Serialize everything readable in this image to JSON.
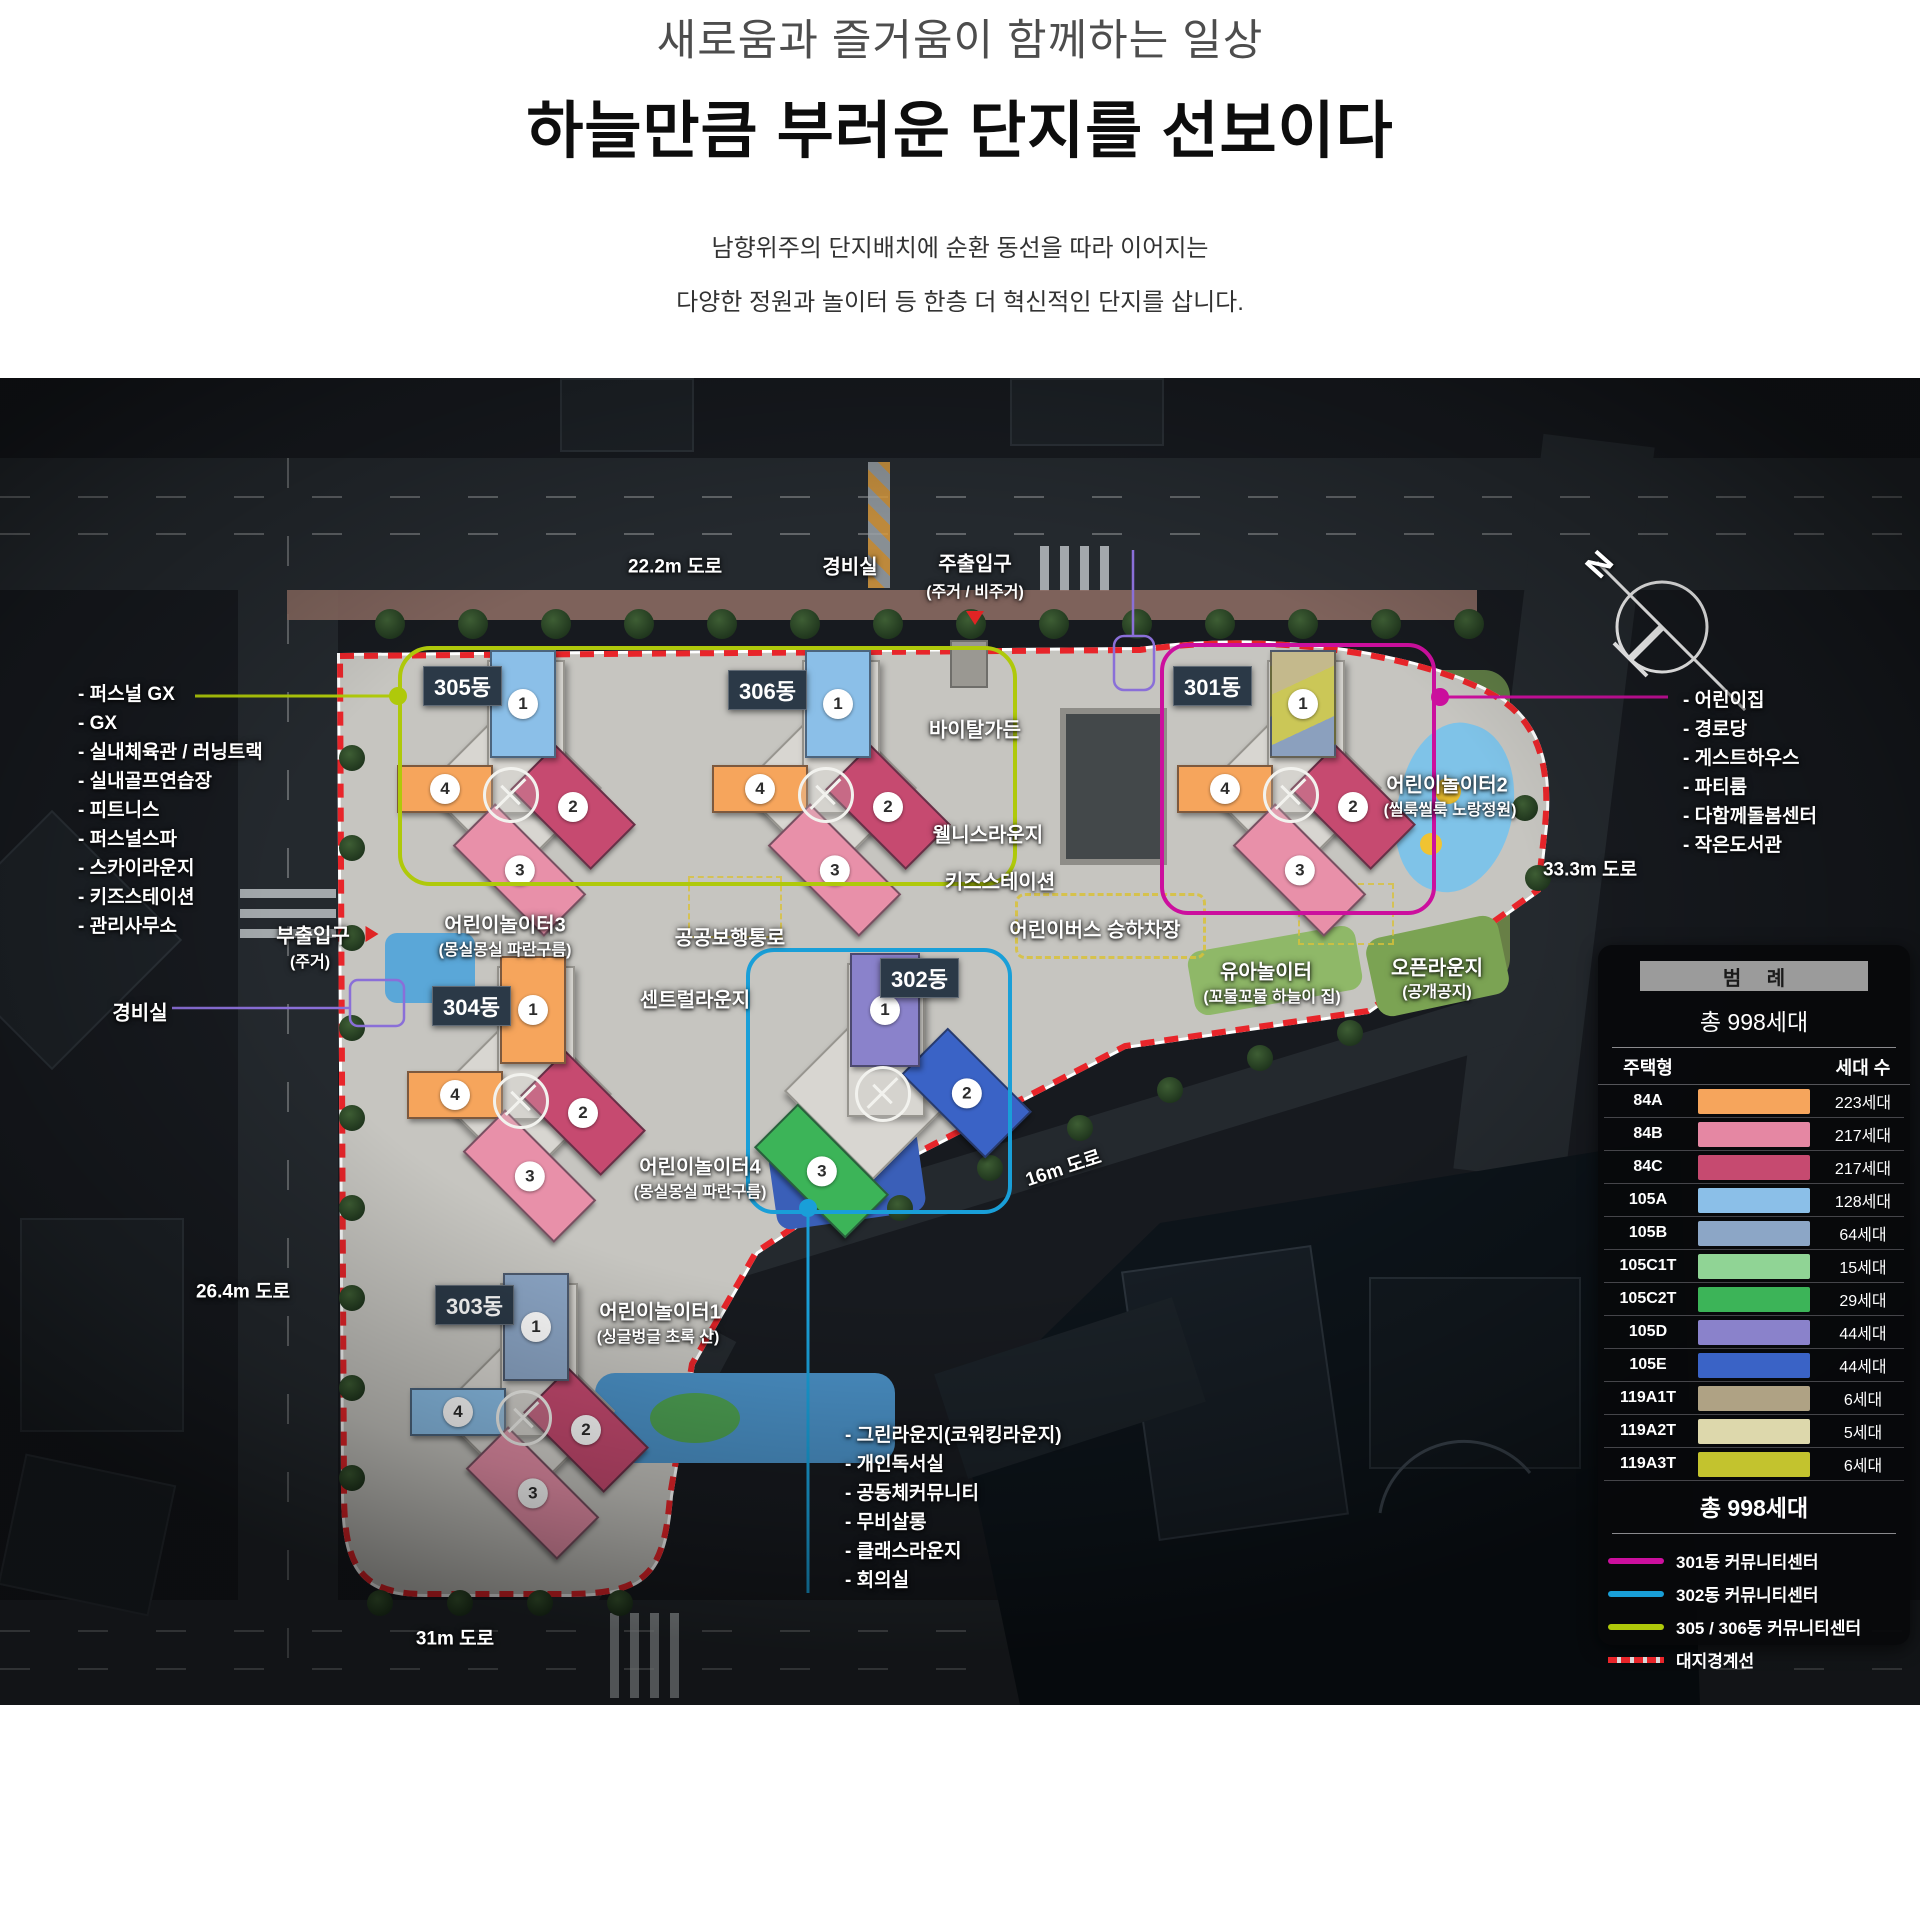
{
  "header": {
    "subtitle": "새로움과 즐거움이 함께하는 일상",
    "title": "하늘만큼 부러운 단지를 선보이다",
    "desc1": "남향위주의 단지배치에 순환 동선을 따라 이어지는",
    "desc2": "다양한 정원과 놀이터 등 한층 더 혁신적인 단지를 삽니다."
  },
  "site_plan": {
    "compass_label": "N",
    "roads": {
      "top": "22.2m 도로",
      "right": "33.3m 도로",
      "left": "26.4m 도로",
      "bottom": "31m 도로",
      "inner": "16m 도로"
    },
    "entrances": {
      "guard_top": "경비실",
      "guard_left": "경비실",
      "main": {
        "title": "주출입구",
        "sub": "(주거 / 비주거)"
      },
      "side": {
        "title": "부출입구",
        "sub": "(주거)"
      }
    },
    "left_facilities": [
      "- 퍼스널 GX",
      "- GX",
      "- 실내체육관 / 러닝트랙",
      "- 실내골프연습장",
      "- 피트니스",
      "- 퍼스널스파",
      "- 스카이라운지",
      "- 키즈스테이션",
      "- 관리사무소"
    ],
    "right_facilities": [
      "- 어린이집",
      "- 경로당",
      "- 게스트하우스",
      "- 파티룸",
      "- 다함께돌봄센터",
      "- 작은도서관"
    ],
    "bottom_facilities": [
      "- 그린라운지(코워킹라운지)",
      "- 개인독서실",
      "- 공동체커뮤니티",
      "- 무비살롱",
      "- 클래스라운지",
      "- 회의실"
    ],
    "areas": {
      "vital_garden": "바이탈가든",
      "wellness_lounge": "웰니스라운지",
      "kids_station": "키즈스테이션",
      "public_walkway": "공공보행통로",
      "kids_bus": "어린이버스 승하차장",
      "central_lounge": "센트럴라운지",
      "infant_play": {
        "title": "유아놀이터",
        "sub": "(꼬물꼬물 하늘이 집)"
      },
      "open_lounge": {
        "title": "오픈라운지",
        "sub": "(공개공지)"
      },
      "playground1": {
        "title": "어린이놀이터1",
        "sub": "(싱글벙글 초록 산)"
      },
      "playground2": {
        "title": "어린이놀이터2",
        "sub": "(씰룩씰룩 노랑정원)"
      },
      "playground3": {
        "title": "어린이놀이터3",
        "sub": "(몽실몽실 파란구름)"
      },
      "playground4": {
        "title": "어린이놀이터4",
        "sub": "(몽실몽실 파란구름)"
      }
    },
    "buildings": [
      {
        "id": "305",
        "label": "305동",
        "x": 395,
        "y": 272,
        "layout": "std",
        "label_dx": 28,
        "label_dy": 16,
        "wings": [
          {
            "n": "1",
            "color": "#8BBFE8"
          },
          {
            "n": "2",
            "color": "#C64A70"
          },
          {
            "n": "3",
            "color": "#E890A9"
          },
          {
            "n": "4",
            "color": "#F6A55C"
          }
        ]
      },
      {
        "id": "306",
        "label": "306동",
        "x": 710,
        "y": 272,
        "layout": "std",
        "label_dx": 18,
        "label_dy": 20,
        "wings": [
          {
            "n": "1",
            "color": "#8BBFE8"
          },
          {
            "n": "2",
            "color": "#C64A70"
          },
          {
            "n": "3",
            "color": "#E890A9"
          },
          {
            "n": "4",
            "color": "#F6A55C"
          }
        ]
      },
      {
        "id": "301",
        "label": "301동",
        "x": 1175,
        "y": 272,
        "layout": "std",
        "label_dx": -2,
        "label_dy": 16,
        "wings": [
          {
            "n": "1",
            "color": "#BCAF82",
            "gradient": "linear-gradient(155deg,#C4B98C 0 32%,#CBC757 32% 70%,#8BA0BE 70% 100%)"
          },
          {
            "n": "2",
            "color": "#C64A70"
          },
          {
            "n": "3",
            "color": "#E890A9"
          },
          {
            "n": "4",
            "color": "#F6A55C"
          }
        ]
      },
      {
        "id": "304",
        "label": "304동",
        "x": 405,
        "y": 578,
        "layout": "std",
        "label_dx": 27,
        "label_dy": 30,
        "wings": [
          {
            "n": "1",
            "color": "#F6A55C"
          },
          {
            "n": "2",
            "color": "#C64A70"
          },
          {
            "n": "3",
            "color": "#E890A9"
          },
          {
            "n": "4",
            "color": "#F6A55C"
          }
        ]
      },
      {
        "id": "302",
        "label": "302동",
        "x": 755,
        "y": 575,
        "layout": "alt",
        "label_dx": 125,
        "label_dy": 5,
        "wings": [
          {
            "n": "1",
            "color": "#8A82CB"
          },
          {
            "n": "2",
            "color": "#3A63C6"
          },
          {
            "n": "3",
            "color": "#3CB458"
          }
        ]
      },
      {
        "id": "303",
        "label": "303동",
        "x": 408,
        "y": 895,
        "layout": "std",
        "label_dx": 27,
        "label_dy": 12,
        "wings": [
          {
            "n": "1",
            "color": "#8CA6C6"
          },
          {
            "n": "2",
            "color": "#C64A70"
          },
          {
            "n": "3",
            "color": "#E890A9"
          },
          {
            "n": "4",
            "color": "#8BBFE8"
          }
        ]
      }
    ],
    "legend": {
      "title": "범 례",
      "total": "총 998세대",
      "col_type": "주택형",
      "col_count": "세대 수",
      "rows": [
        {
          "type": "84A",
          "color": "#F6A55C",
          "count": "223세대"
        },
        {
          "type": "84B",
          "color": "#E587A3",
          "count": "217세대"
        },
        {
          "type": "84C",
          "color": "#C64A70",
          "count": "217세대"
        },
        {
          "type": "105A",
          "color": "#8BBFE8",
          "count": "128세대"
        },
        {
          "type": "105B",
          "color": "#8CA6C6",
          "count": "64세대"
        },
        {
          "type": "105C1T",
          "color": "#90D495",
          "count": "15세대"
        },
        {
          "type": "105C2T",
          "color": "#3CB458",
          "count": "29세대"
        },
        {
          "type": "105D",
          "color": "#8A82CB",
          "count": "44세대"
        },
        {
          "type": "105E",
          "color": "#3A63C6",
          "count": "44세대"
        },
        {
          "type": "119A1T",
          "color": "#AFA284",
          "count": "6세대"
        },
        {
          "type": "119A2T",
          "color": "#DDD8AC",
          "count": "5세대"
        },
        {
          "type": "119A3T",
          "color": "#C3C32E",
          "count": "6세대"
        }
      ],
      "total_bottom": "총 998세대",
      "community": [
        {
          "color": "#CC0F9E",
          "label": "301동 커뮤니티센터"
        },
        {
          "color": "#199FD8",
          "label": "302동 커뮤니티센터"
        },
        {
          "color": "#AFC90A",
          "label": "305 / 306동 커뮤니티센터"
        }
      ],
      "boundary_label": "대지경계선",
      "boundary_color": "#E8252A"
    }
  }
}
